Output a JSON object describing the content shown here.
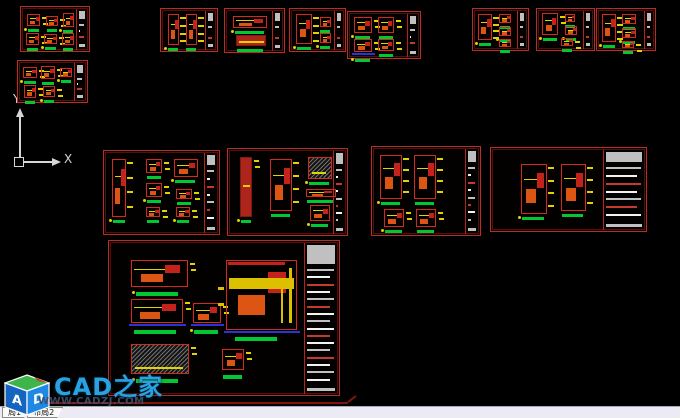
{
  "app": {
    "background": "#000000"
  },
  "ucs": {
    "x_label": "X",
    "y_label": "Y"
  },
  "watermark": {
    "site_name": "CAD之家",
    "site_url": "WWW.CADZJ.COM",
    "logo_letters": [
      "A",
      "D"
    ]
  },
  "layout_tabs": [
    {
      "label": "局1"
    },
    {
      "label": "布局2"
    }
  ],
  "palette": {
    "sheet_border": "#bf2b22",
    "detail_red": "#d42a1e",
    "detail_fill": "#ad241b",
    "dim_yellow": "#e0d400",
    "orange": "#dd5512",
    "label_green": "#00c832",
    "base_blue": "#2a32d8",
    "strip_gray": "#c0c0c0",
    "strip_white": "#f2f2f2",
    "strip_red": "#c23b2e",
    "ucs_color": "#d6d6d6",
    "watermark_blue": "#29a2e2",
    "url_color": "#3f4f6b",
    "underline_red": "#7c150f",
    "tabbar_bg": "#eceaf4"
  },
  "sheets": [
    {
      "id": "sheet-01",
      "x": 20,
      "y": 6,
      "w": 70,
      "h": 46,
      "sw": 12,
      "blobs": [
        [
          6,
          7,
          13,
          12
        ],
        [
          25,
          9,
          12,
          10
        ],
        [
          42,
          6,
          11,
          14
        ],
        [
          5,
          26,
          13,
          12
        ],
        [
          23,
          27,
          13,
          10
        ],
        [
          41,
          26,
          12,
          12
        ]
      ]
    },
    {
      "id": "sheet-02",
      "x": 17,
      "y": 60,
      "w": 71,
      "h": 43,
      "sw": 12,
      "blobs": [
        [
          5,
          6,
          14,
          11
        ],
        [
          23,
          5,
          14,
          13
        ],
        [
          42,
          7,
          12,
          9
        ],
        [
          6,
          24,
          12,
          13
        ],
        [
          25,
          25,
          12,
          11
        ]
      ]
    },
    {
      "id": "sheet-03",
      "x": 160,
      "y": 8,
      "w": 58,
      "h": 44,
      "sw": 11,
      "blobs": [
        [
          7,
          5,
          11,
          31,
          "tall"
        ],
        [
          25,
          5,
          11,
          31,
          "tall"
        ]
      ]
    },
    {
      "id": "sheet-04",
      "x": 224,
      "y": 8,
      "w": 61,
      "h": 45,
      "sw": 11,
      "blobs": [
        [
          8,
          7,
          34,
          12
        ],
        [
          11,
          26,
          30,
          11,
          "fill"
        ]
      ]
    },
    {
      "id": "sheet-05",
      "x": 289,
      "y": 8,
      "w": 57,
      "h": 44,
      "sw": 10,
      "blobs": [
        [
          6,
          5,
          16,
          30,
          "tall"
        ],
        [
          30,
          8,
          11,
          10
        ],
        [
          30,
          24,
          11,
          10
        ]
      ]
    },
    {
      "id": "sheet-06",
      "x": 347,
      "y": 11,
      "w": 74,
      "h": 48,
      "sw": 12,
      "blobs": [
        [
          6,
          5,
          18,
          16
        ],
        [
          30,
          5,
          16,
          16
        ],
        [
          6,
          27,
          18,
          13,
          "el"
        ],
        [
          30,
          27,
          16,
          12
        ]
      ]
    },
    {
      "id": "sheet-07",
      "x": 472,
      "y": 8,
      "w": 57,
      "h": 43,
      "sw": 10,
      "blobs": [
        [
          5,
          5,
          14,
          26,
          "tall"
        ],
        [
          26,
          5,
          12,
          9
        ],
        [
          26,
          18,
          12,
          9
        ],
        [
          26,
          30,
          12,
          8
        ]
      ]
    },
    {
      "id": "sheet-08",
      "x": 536,
      "y": 8,
      "w": 59,
      "h": 43,
      "sw": 10,
      "blobs": [
        [
          5,
          4,
          16,
          22
        ],
        [
          28,
          5,
          10,
          8
        ],
        [
          28,
          17,
          12,
          9
        ],
        [
          24,
          29,
          12,
          8
        ]
      ]
    },
    {
      "id": "sheet-09",
      "x": 596,
      "y": 8,
      "w": 60,
      "h": 43,
      "sw": 10,
      "blobs": [
        [
          5,
          5,
          14,
          28,
          "tall"
        ],
        [
          25,
          5,
          14,
          10
        ],
        [
          25,
          19,
          14,
          10
        ],
        [
          25,
          32,
          12,
          7
        ]
      ]
    },
    {
      "id": "sheet-10",
      "x": 103,
      "y": 150,
      "w": 117,
      "h": 85,
      "sw": 14,
      "blobs": [
        [
          8,
          8,
          14,
          58,
          "tall"
        ],
        [
          42,
          8,
          16,
          14
        ],
        [
          42,
          32,
          16,
          14
        ],
        [
          42,
          56,
          14,
          10
        ],
        [
          70,
          8,
          24,
          18
        ],
        [
          72,
          38,
          16,
          10
        ],
        [
          72,
          56,
          14,
          10
        ]
      ]
    },
    {
      "id": "sheet-11",
      "x": 227,
      "y": 148,
      "w": 121,
      "h": 88,
      "sw": 13,
      "blobs": [
        [
          12,
          8,
          12,
          60,
          "fill"
        ],
        [
          42,
          10,
          22,
          52,
          "tall"
        ],
        [
          80,
          8,
          24,
          22,
          "hatch"
        ],
        [
          78,
          40,
          30,
          8
        ],
        [
          82,
          56,
          20,
          16
        ]
      ]
    },
    {
      "id": "sheet-12",
      "x": 371,
      "y": 146,
      "w": 110,
      "h": 90,
      "sw": 14,
      "blobs": [
        [
          8,
          8,
          22,
          44,
          "tall"
        ],
        [
          42,
          8,
          22,
          44,
          "tall"
        ],
        [
          12,
          62,
          20,
          18
        ],
        [
          44,
          62,
          20,
          18
        ]
      ]
    },
    {
      "id": "sheet-13",
      "x": 490,
      "y": 147,
      "w": 157,
      "h": 85,
      "sw": 42,
      "blobs": [
        [
          30,
          16,
          26,
          50,
          "tall"
        ],
        [
          70,
          16,
          25,
          47,
          "tall"
        ]
      ]
    },
    {
      "id": "sheet-14",
      "x": 108,
      "y": 240,
      "w": 232,
      "h": 156,
      "sw": 34,
      "big": true,
      "blobs": [
        [
          22,
          19,
          57,
          27
        ],
        [
          22,
          58,
          52,
          24,
          "el"
        ],
        [
          84,
          62,
          28,
          20,
          "el"
        ],
        [
          117,
          19,
          71,
          70,
          "sec"
        ],
        [
          22,
          103,
          58,
          30,
          "hatch"
        ],
        [
          113,
          108,
          22,
          21,
          "small"
        ]
      ]
    }
  ]
}
